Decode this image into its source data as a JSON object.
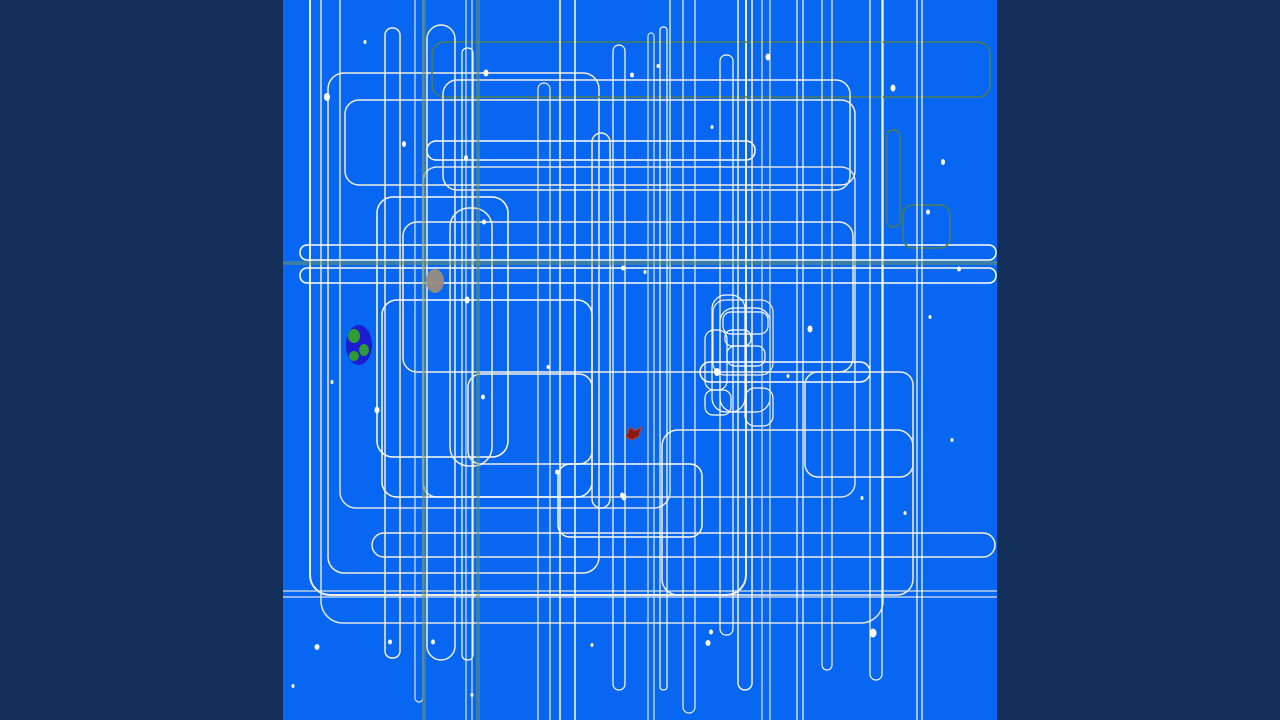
{
  "artwork": {
    "width": 1280,
    "height": 720,
    "background_color": "#152f5b",
    "canvas": {
      "x": 283,
      "y": 0,
      "width": 714,
      "height": 720,
      "color": "#0767f3"
    },
    "palette": {
      "ivory": "#f2efe2",
      "white": "#ffffff",
      "pale": "#dce3e8",
      "green": "#4e7d52",
      "olive": "#6f945c"
    },
    "rects": [
      [
        310,
        -24,
        436,
        619,
        20,
        "ivory",
        2
      ],
      [
        321,
        -40,
        562,
        663,
        22,
        "pale",
        1.5
      ],
      [
        328,
        73,
        271,
        500,
        16,
        "ivory",
        1.5
      ],
      [
        345,
        100,
        510,
        85,
        14,
        "ivory",
        1.5
      ],
      [
        432,
        42,
        558,
        55,
        12,
        "green",
        1.5
      ],
      [
        443,
        80,
        407,
        110,
        14,
        "ivory",
        1.5
      ],
      [
        427,
        141,
        328,
        19,
        9,
        "white",
        1.5
      ],
      [
        423,
        167,
        432,
        330,
        14,
        "pale",
        1.5
      ],
      [
        377,
        197,
        131,
        260,
        16,
        "white",
        1.5
      ],
      [
        450,
        208,
        42,
        258,
        19,
        "ivory",
        1.5
      ],
      [
        403,
        222,
        450,
        150,
        14,
        "ivory",
        1.5
      ],
      [
        300,
        245,
        696,
        15,
        7,
        "white",
        1.5
      ],
      [
        300,
        268,
        696,
        15,
        7,
        "white",
        1.5
      ],
      [
        382,
        300,
        210,
        197,
        15,
        "white",
        1.5
      ],
      [
        468,
        374,
        124,
        90,
        13,
        "ivory",
        1.5
      ],
      [
        340,
        -30,
        330,
        538,
        16,
        "pale",
        1.5
      ],
      [
        662,
        430,
        251,
        165,
        16,
        "ivory",
        1.5
      ],
      [
        700,
        362,
        170,
        20,
        10,
        "white",
        1.5
      ],
      [
        805,
        372,
        108,
        105,
        13,
        "ivory",
        1.5
      ],
      [
        558,
        464,
        144,
        73,
        12,
        "white",
        1.5
      ],
      [
        372,
        533,
        623,
        24,
        12,
        "ivory",
        1.5
      ],
      [
        250,
        591,
        770,
        6,
        3,
        "pale",
        1.2
      ],
      [
        712,
        295,
        33,
        117,
        14,
        "white",
        1.2
      ],
      [
        720,
        308,
        50,
        104,
        14,
        "white",
        1.2
      ],
      [
        713,
        300,
        60,
        75,
        12,
        "ivory",
        1.2
      ],
      [
        723,
        312,
        45,
        22,
        8,
        "white",
        1.2
      ],
      [
        725,
        330,
        26,
        16,
        7,
        "white",
        1.2
      ],
      [
        727,
        346,
        38,
        20,
        8,
        "white",
        1.2
      ],
      [
        705,
        330,
        22,
        60,
        9,
        "white",
        1.2
      ],
      [
        705,
        390,
        26,
        25,
        8,
        "white",
        1.2
      ],
      [
        745,
        388,
        28,
        38,
        10,
        "white",
        1.2
      ],
      [
        385,
        28,
        15,
        630,
        7,
        "ivory",
        1.5
      ],
      [
        415,
        -10,
        8,
        712,
        4,
        "pale",
        1.2
      ],
      [
        427,
        25,
        28,
        635,
        14,
        "ivory",
        1.5
      ],
      [
        462,
        48,
        11,
        612,
        5,
        "white",
        1.2
      ],
      [
        466,
        -20,
        6,
        762,
        3,
        "pale",
        1.2
      ],
      [
        538,
        83,
        12,
        650,
        6,
        "ivory",
        1.2
      ],
      [
        560,
        -20,
        15,
        762,
        7,
        "white",
        1.5
      ],
      [
        592,
        133,
        18,
        375,
        9,
        "ivory",
        1.5
      ],
      [
        613,
        45,
        12,
        645,
        6,
        "white",
        1.2
      ],
      [
        648,
        33,
        6,
        700,
        3,
        "pale",
        1.2
      ],
      [
        660,
        27,
        7,
        663,
        3,
        "white",
        1.2
      ],
      [
        683,
        -20,
        12,
        733,
        6,
        "ivory",
        1.2
      ],
      [
        720,
        55,
        13,
        580,
        6,
        "white",
        1.2
      ],
      [
        738,
        -20,
        14,
        710,
        7,
        "ivory",
        1.5
      ],
      [
        762,
        -20,
        8,
        762,
        4,
        "pale",
        1.2
      ],
      [
        797,
        -20,
        6,
        762,
        3,
        "white",
        1.2
      ],
      [
        822,
        -20,
        10,
        690,
        5,
        "ivory",
        1.2
      ],
      [
        870,
        -20,
        12,
        700,
        6,
        "white",
        1.2
      ],
      [
        887,
        130,
        13,
        97,
        6,
        "green",
        1.5
      ],
      [
        903,
        205,
        47,
        43,
        10,
        "green",
        1.5
      ],
      [
        917,
        -20,
        5,
        762,
        2,
        "white",
        1.2
      ],
      [
        283,
        262,
        714,
        2,
        1,
        "olive",
        1
      ],
      [
        423,
        -20,
        2,
        762,
        1,
        "olive",
        1
      ],
      [
        477,
        -20,
        2,
        762,
        1,
        "olive",
        1
      ]
    ],
    "stars": {
      "color": "#fffff4",
      "points": [
        [
          365,
          42,
          1.5,
          2
        ],
        [
          327,
          97,
          3,
          4
        ],
        [
          404,
          144,
          2,
          3
        ],
        [
          486,
          73,
          2.5,
          3.5
        ],
        [
          466,
          158,
          2,
          3
        ],
        [
          632,
          75,
          2,
          2.5
        ],
        [
          658,
          66,
          1.5,
          2
        ],
        [
          712,
          127,
          1.5,
          2
        ],
        [
          768,
          57,
          2.5,
          3.5
        ],
        [
          893,
          88,
          2.5,
          3.5
        ],
        [
          943,
          162,
          2,
          3
        ],
        [
          928,
          212,
          2,
          2.5
        ],
        [
          959,
          269,
          2,
          2.5
        ],
        [
          930,
          317,
          1.5,
          2
        ],
        [
          623,
          268,
          2,
          2.5
        ],
        [
          645,
          272,
          1.5,
          2
        ],
        [
          810,
          329,
          2.5,
          3.5
        ],
        [
          467,
          300,
          2.5,
          3.5
        ],
        [
          484,
          222,
          2,
          2.5
        ],
        [
          548,
          367,
          1.5,
          2
        ],
        [
          717,
          372,
          3,
          4
        ],
        [
          788,
          376,
          1.5,
          2
        ],
        [
          377,
          410,
          2.5,
          3.5
        ],
        [
          332,
          382,
          1.5,
          2
        ],
        [
          483,
          397,
          2,
          2.5
        ],
        [
          622,
          495,
          2,
          2.5
        ],
        [
          862,
          498,
          1.5,
          2
        ],
        [
          905,
          513,
          1.5,
          2
        ],
        [
          557,
          472,
          2,
          2.5
        ],
        [
          624,
          497,
          2.5,
          3.5
        ],
        [
          873,
          633,
          3.5,
          4.5
        ],
        [
          708,
          643,
          2.5,
          3
        ],
        [
          592,
          645,
          1.5,
          2
        ],
        [
          711,
          632,
          2,
          2.5
        ],
        [
          317,
          647,
          2.5,
          3
        ],
        [
          390,
          642,
          2,
          2.5
        ],
        [
          433,
          642,
          2,
          2.5
        ],
        [
          293,
          686,
          1.5,
          2
        ],
        [
          472,
          695,
          1.5,
          2
        ],
        [
          952,
          440,
          1.5,
          2
        ]
      ]
    },
    "earth": {
      "cx": 359,
      "cy": 345,
      "rx": 13,
      "ry": 20,
      "body_color": "#1c1cd0",
      "land_color": "#2e9c33",
      "patches": [
        [
          354,
          336,
          6,
          7
        ],
        [
          364,
          350,
          5,
          6
        ],
        [
          354,
          356,
          5,
          5
        ]
      ]
    },
    "moon": {
      "cx": 435,
      "cy": 281,
      "rx": 9,
      "ry": 12,
      "color": "#9a8c7d"
    },
    "ship": {
      "points": "626,437 630,427 635,431 641,427 639,436 632,440",
      "fill": "#8f1a12",
      "stroke": "#c23b2a"
    }
  }
}
